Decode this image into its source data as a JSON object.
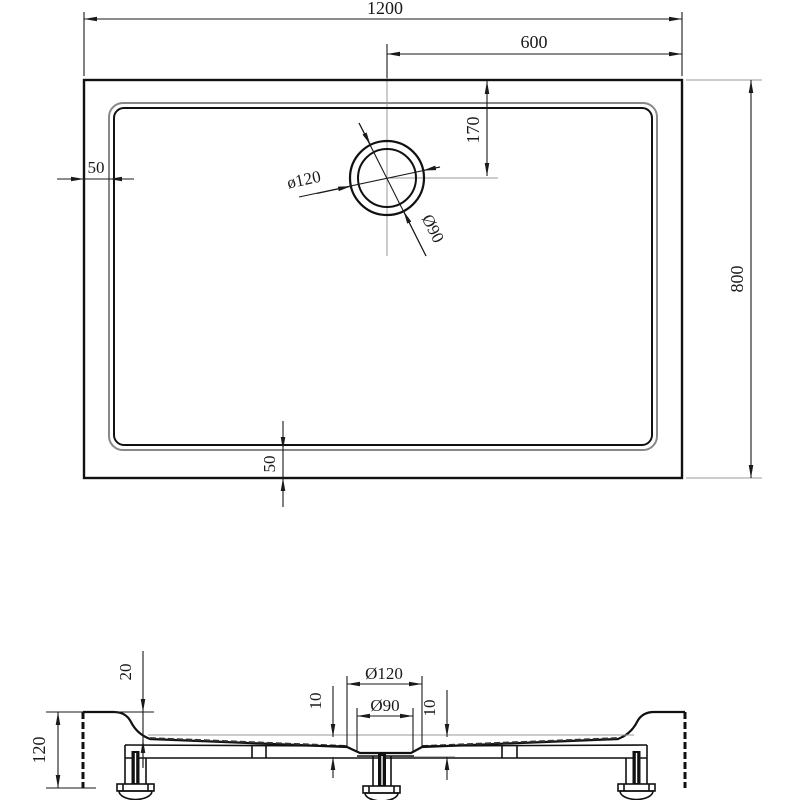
{
  "drawing": {
    "background": "#ffffff",
    "line_color": "#1a1a1a",
    "rim_color": "#888888",
    "centerline_color": "#9a9a9a",
    "top_view": {
      "dim_width_total": "1200",
      "dim_drain_to_right": "600",
      "dim_drain_from_top": "170",
      "dim_rim_inset_left": "50",
      "dim_rim_inset_bottom": "50",
      "dim_height_total": "800",
      "dim_drain_outer_dia": "ø120",
      "dim_drain_inner_dia": "Ø90"
    },
    "section_view": {
      "dim_total_height": "120",
      "dim_rim_height": "20",
      "dim_recess_depth_left": "10",
      "dim_recess_depth_right": "10",
      "dim_drain_outer_dia": "Ø120",
      "dim_drain_inner_dia": "Ø90"
    }
  }
}
